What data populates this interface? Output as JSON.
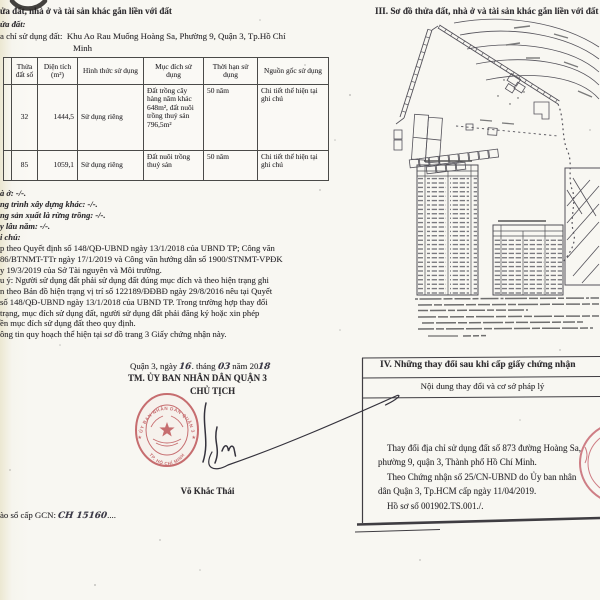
{
  "colors": {
    "seal_red": "#c05a5e",
    "ink_text": "#2e2c30",
    "handwriting": "#3b3947",
    "paper": "#f8f7f2"
  },
  "left_page": {
    "heading_cut": "ửa đất, nhà ở và tài sản khác gắn liền với đất",
    "parcel_label_cut": "ửa đất:",
    "address_label_cut": "a chỉ sử dụng đất:",
    "address_line1": "Khu Ao Rau Muống Hoàng Sa, Phường 9, Quận 3, Tp.Hồ Chí",
    "address_line2": "Minh",
    "table": {
      "headers": [
        "",
        "Thửa đất số",
        "Diện tích (m²)",
        "Hình thức sử dụng",
        "Mục đích sử dụng",
        "Thời hạn sử dụng",
        "Nguồn gốc sử dụng"
      ],
      "rows": [
        [
          "",
          "32",
          "1444,5",
          "Sử dụng riêng",
          "Đất trồng cây hàng năm khác 648m², đất nuôi trồng thuỷ sản 796,5m²",
          "50 năm",
          "Chi tiết thể hiện tại ghi chú"
        ],
        [
          "",
          "85",
          "1059,1",
          "Sử dụng riêng",
          "Đất nuôi trồng thuỷ sản",
          "50 năm",
          "Chi tiết thể hiện tại ghi chú"
        ]
      ]
    },
    "asset_lines": [
      "à ở: -/-.",
      "ng trình xây dựng khác: -/-.",
      "ng sản xuất là rừng trồng: -/-.",
      "y lâu năm: -/-.",
      "i chú:"
    ],
    "note_lines": [
      "p theo Quyết định số 148/QĐ-UBND ngày 13/1/2018 của UBND TP; Công văn",
      "86/BTNMT-TTr ngày 17/1/2019 và Công văn hướng dẫn số 1900/STNMT-VPĐK",
      "y 19/3/2019 của Sở Tài nguyên và Môi trường.",
      "u ý: Người sử dụng đất phải sử dụng đất đúng mục đích và theo hiện trạng ghi",
      "n theo Bản đồ hiện trạng vị trí số 122189/ĐĐBĐ ngày 29/8/2016 nêu tại Quyết",
      "số 148/QĐ-UBND ngày 13/1/2018 của UBND TP. Trong trường hợp thay đổi",
      "trạng, mục đích sử dụng đất, người sử dụng đất phải đăng ký hoặc xin phép",
      "ền mục đích sử dụng đất theo quy định.",
      "ông tin quy hoạch thể hiện tại sơ đồ trang 3 Giấy chứng nhận này."
    ],
    "date": {
      "prefix": "Quận 3, ngày",
      "day": "16",
      "mid1": ". tháng",
      "month": "03",
      "mid2": "năm 20",
      "year": "18"
    },
    "authority_line1": "TM. ỦY BAN NHÂN DÂN QUẬN 3",
    "authority_line2": "CHỦ TỊCH",
    "signer_name": "Võ Khắc Thái",
    "seal": {
      "arc_top": "ỦY BAN NHÂN DÂN QUẬN 3",
      "arc_bottom": "TP. HỒ CHÍ MINH"
    },
    "gcn": {
      "prefix": "ào sổ cấp GCN:",
      "number": "CH 15160",
      "dots": "...."
    }
  },
  "right_page": {
    "heading": "III. Sơ đồ thửa đất, nhà ở và tài sản khác gắn liền với đất",
    "section4": {
      "title": "IV. Những thay đổi sau khi cấp giấy chứng nhận",
      "column_header": "Nội dung thay đổi và cơ sở pháp lý",
      "body_lines": [
        "Thay đổi địa chỉ sử dụng đất số 873 đường Hoàng Sa,",
        "phường 9, quận 3, Thành phố Hồ Chí Minh.",
        "Theo Chứng nhận số 25/CN-UBND do Ủy ban nhân",
        "dân Quận 3, Tp.HCM cấp ngày 11/04/2019.",
        "Hồ sơ số 001902.TS.001./."
      ]
    }
  }
}
